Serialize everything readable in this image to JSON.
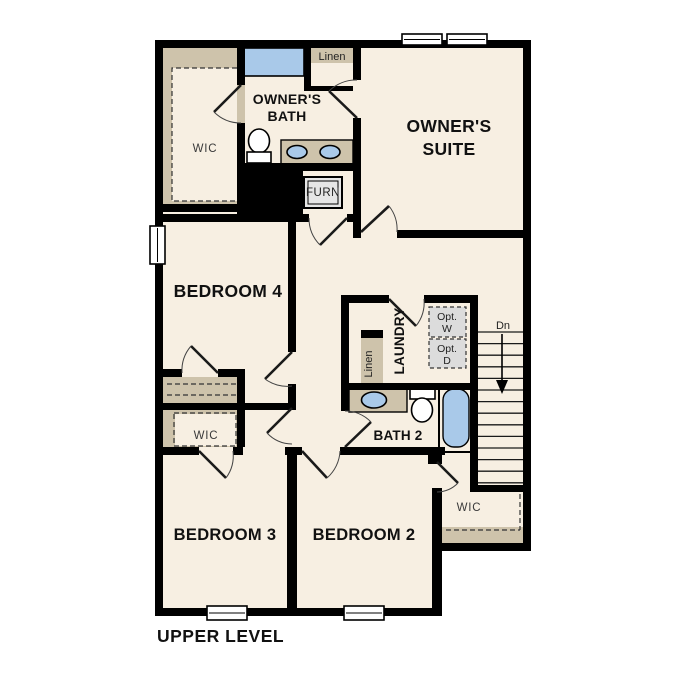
{
  "title": "UPPER LEVEL",
  "rooms": {
    "owners_bath": {
      "line1": "OWNER'S",
      "line2": "BATH"
    },
    "owners_suite": {
      "line1": "OWNER'S",
      "line2": "SUITE"
    },
    "owners_wic": "WIC",
    "linen_upper": "Linen",
    "furnace": "FURN",
    "bedroom4": "BEDROOM 4",
    "laundry": "LAUNDRY",
    "linen_hall": "Linen",
    "opt_washer": {
      "line1": "Opt.",
      "line2": "W"
    },
    "opt_dryer": {
      "line1": "Opt.",
      "line2": "D"
    },
    "stairs_down": "Dn",
    "bath2": "BATH 2",
    "bedroom3_wic": "WIC",
    "bedroom3": "BEDROOM 3",
    "bedroom2": "BEDROOM 2",
    "bedroom2_wic": "WIC"
  },
  "colors": {
    "wall": "#000000",
    "floor": "#f7efe2",
    "shelf": "#cec3ab",
    "fixture": "#a9c9e9",
    "optbox": "#dcdcdc",
    "furnbox": "#e6e6e6"
  }
}
